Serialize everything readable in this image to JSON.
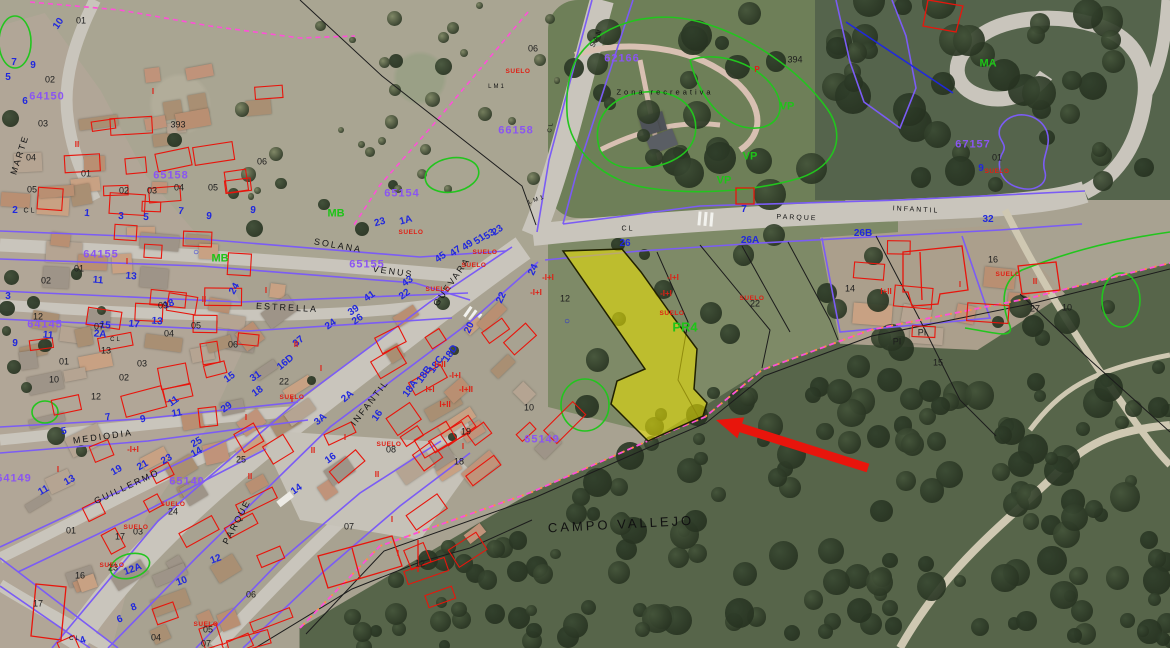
{
  "map": {
    "description": "Aerial cadastral map with highlighted parcel",
    "colors": {
      "highlight_fill": "#f0e800",
      "highlight_outline": "#202000",
      "arrow": "#e8150c",
      "street_line": "#7b5cf5",
      "portal_number": "#2028dd",
      "parcel_line_red": "#e8150c",
      "zone_green": "#1ec418",
      "boundary_magenta": "#ff50d8"
    },
    "highlight": {
      "parcel_polygon": [
        [
          563,
          251
        ],
        [
          622,
          249
        ],
        [
          641,
          272
        ],
        [
          668,
          310
        ],
        [
          697,
          349
        ],
        [
          694,
          389
        ],
        [
          707,
          403
        ],
        [
          703,
          416
        ],
        [
          648,
          441
        ],
        [
          611,
          404
        ],
        [
          617,
          381
        ],
        [
          645,
          369
        ]
      ],
      "arrow": {
        "tail": [
          868,
          468
        ],
        "head": [
          716,
          420
        ]
      }
    },
    "street_names": [
      {
        "t": "MARTE",
        "x": 20,
        "y": 155,
        "r": -72
      },
      {
        "t": "VENUS",
        "x": 393,
        "y": 272,
        "r": 8
      },
      {
        "t": "ESTRELLA",
        "x": 287,
        "y": 308,
        "r": 3
      },
      {
        "t": "SOLANA",
        "x": 338,
        "y": 246,
        "r": 10
      },
      {
        "t": "MEDIODIA",
        "x": 103,
        "y": 437,
        "r": -8
      },
      {
        "t": "GUILLERMO",
        "x": 127,
        "y": 487,
        "r": -25
      },
      {
        "t": "GUEVARA",
        "x": 452,
        "y": 282,
        "r": -55
      },
      {
        "t": "INFANTIL",
        "x": 370,
        "y": 403,
        "r": -52
      },
      {
        "t": "INFANTIL",
        "x": 916,
        "y": 210,
        "r": 3,
        "s": 7
      },
      {
        "t": "PARQUE",
        "x": 797,
        "y": 218,
        "r": 2,
        "s": 7
      },
      {
        "t": "PARQUE",
        "x": 237,
        "y": 522,
        "r": -62
      },
      {
        "t": "SAN",
        "x": 597,
        "y": 38,
        "r": -65,
        "s": 7
      },
      {
        "t": "CL",
        "x": 30,
        "y": 211,
        "r": 0,
        "s": 7
      },
      {
        "t": "CL",
        "x": 116,
        "y": 340,
        "r": 0,
        "s": 6
      },
      {
        "t": "CL",
        "x": 628,
        "y": 229,
        "r": 0,
        "s": 7
      },
      {
        "t": "CL",
        "x": 551,
        "y": 127,
        "r": -80,
        "s": 6
      },
      {
        "t": "CL",
        "x": 75,
        "y": 639,
        "r": 0,
        "s": 6
      },
      {
        "t": "LM1",
        "x": 497,
        "y": 87,
        "r": 0,
        "s": 6
      },
      {
        "t": "LM1",
        "x": 537,
        "y": 200,
        "r": -20,
        "s": 6
      }
    ],
    "area_labels": [
      {
        "t": "CAMPO VALLEJO",
        "x": 621,
        "y": 524,
        "r": -3,
        "s": 13
      },
      {
        "t": "Zona recreativa",
        "x": 665,
        "y": 92,
        "r": 0,
        "s": 7.5
      }
    ],
    "zone_labels": [
      {
        "t": "VP",
        "x": 787,
        "y": 107
      },
      {
        "t": "VP",
        "x": 750,
        "y": 157
      },
      {
        "t": "VP",
        "x": 724,
        "y": 181
      },
      {
        "t": "MA",
        "x": 988,
        "y": 64
      },
      {
        "t": "MB",
        "x": 336,
        "y": 214
      },
      {
        "t": "MB",
        "x": 220,
        "y": 259
      },
      {
        "t": "PR4",
        "x": 685,
        "y": 327,
        "r": 0,
        "s": 13
      }
    ],
    "block_codes": [
      {
        "t": "64150",
        "x": 47,
        "y": 97
      },
      {
        "t": "65158",
        "x": 171,
        "y": 176
      },
      {
        "t": "64155",
        "x": 101,
        "y": 255
      },
      {
        "t": "64145",
        "x": 45,
        "y": 325
      },
      {
        "t": "64149",
        "x": 14,
        "y": 479
      },
      {
        "t": "65140",
        "x": 187,
        "y": 482
      },
      {
        "t": "65155",
        "x": 367,
        "y": 265
      },
      {
        "t": "65154",
        "x": 402,
        "y": 194
      },
      {
        "t": "65149",
        "x": 542,
        "y": 440
      },
      {
        "t": "62166",
        "x": 622,
        "y": 59
      },
      {
        "t": "66158",
        "x": 516,
        "y": 131
      },
      {
        "t": "67157",
        "x": 973,
        "y": 145
      }
    ],
    "street_numbers": [
      {
        "t": "10",
        "x": 59,
        "y": 24,
        "r": -55
      },
      {
        "t": "9",
        "x": 33,
        "y": 66
      },
      {
        "t": "7",
        "x": 14,
        "y": 63
      },
      {
        "t": "6",
        "x": 25,
        "y": 102
      },
      {
        "t": "5",
        "x": 8,
        "y": 78
      },
      {
        "t": "2",
        "x": 15,
        "y": 211
      },
      {
        "t": "1",
        "x": 87,
        "y": 214,
        "r": 5
      },
      {
        "t": "3",
        "x": 121,
        "y": 217,
        "r": 5
      },
      {
        "t": "5",
        "x": 146,
        "y": 218,
        "r": 5
      },
      {
        "t": "7",
        "x": 181,
        "y": 212,
        "r": 5
      },
      {
        "t": "9",
        "x": 209,
        "y": 217,
        "r": 5
      },
      {
        "t": "9",
        "x": 253,
        "y": 211,
        "r": 5
      },
      {
        "t": "11",
        "x": 98,
        "y": 281,
        "r": 5
      },
      {
        "t": "13",
        "x": 131,
        "y": 277,
        "r": 5
      },
      {
        "t": "18",
        "x": 169,
        "y": 305,
        "r": -20
      },
      {
        "t": "15",
        "x": 105,
        "y": 326,
        "r": 5
      },
      {
        "t": "17",
        "x": 134,
        "y": 325,
        "r": 5
      },
      {
        "t": "13",
        "x": 157,
        "y": 322,
        "r": 5
      },
      {
        "t": "11",
        "x": 48,
        "y": 336,
        "r": 5
      },
      {
        "t": "9",
        "x": 15,
        "y": 344,
        "r": 5
      },
      {
        "t": "3",
        "x": 8,
        "y": 297
      },
      {
        "t": "2A",
        "x": 100,
        "y": 335,
        "r": 5
      },
      {
        "t": "23",
        "x": 380,
        "y": 223,
        "r": -15
      },
      {
        "t": "1A",
        "x": 406,
        "y": 221,
        "r": -15
      },
      {
        "t": "43",
        "x": 408,
        "y": 282,
        "r": -35
      },
      {
        "t": "41",
        "x": 370,
        "y": 297,
        "r": -35
      },
      {
        "t": "39",
        "x": 354,
        "y": 311,
        "r": -35
      },
      {
        "t": "26",
        "x": 358,
        "y": 320,
        "r": -35
      },
      {
        "t": "22",
        "x": 405,
        "y": 295,
        "r": -35
      },
      {
        "t": "24",
        "x": 331,
        "y": 325,
        "r": -35
      },
      {
        "t": "45",
        "x": 441,
        "y": 258,
        "r": -35
      },
      {
        "t": "47",
        "x": 456,
        "y": 252,
        "r": -35
      },
      {
        "t": "49",
        "x": 468,
        "y": 246,
        "r": -35
      },
      {
        "t": "51",
        "x": 480,
        "y": 240,
        "r": -35
      },
      {
        "t": "53",
        "x": 490,
        "y": 235,
        "r": -35
      },
      {
        "t": "23",
        "x": 498,
        "y": 231,
        "r": -35
      },
      {
        "t": "24",
        "x": 534,
        "y": 270,
        "r": -65
      },
      {
        "t": "22",
        "x": 502,
        "y": 298,
        "r": -65
      },
      {
        "t": "20",
        "x": 470,
        "y": 328,
        "r": -65
      },
      {
        "t": "18A",
        "x": 411,
        "y": 389,
        "r": -55
      },
      {
        "t": "18B",
        "x": 425,
        "y": 375,
        "r": -55
      },
      {
        "t": "18C",
        "x": 437,
        "y": 365,
        "r": -55
      },
      {
        "t": "18D",
        "x": 451,
        "y": 354,
        "r": -55
      },
      {
        "t": "16D",
        "x": 286,
        "y": 363,
        "r": -40
      },
      {
        "t": "37",
        "x": 299,
        "y": 342,
        "r": -40
      },
      {
        "t": "3A",
        "x": 321,
        "y": 420,
        "r": -40
      },
      {
        "t": "2A",
        "x": 348,
        "y": 397,
        "r": -40
      },
      {
        "t": "16",
        "x": 378,
        "y": 416,
        "r": -55
      },
      {
        "t": "16",
        "x": 331,
        "y": 459,
        "r": -35
      },
      {
        "t": "14",
        "x": 297,
        "y": 490,
        "r": -35
      },
      {
        "t": "15",
        "x": 230,
        "y": 378,
        "r": -35
      },
      {
        "t": "31",
        "x": 256,
        "y": 377,
        "r": -35
      },
      {
        "t": "18",
        "x": 258,
        "y": 392,
        "r": -35
      },
      {
        "t": "29",
        "x": 227,
        "y": 408,
        "r": -35
      },
      {
        "t": "11",
        "x": 174,
        "y": 402,
        "r": -35
      },
      {
        "t": "24",
        "x": 235,
        "y": 289,
        "r": -60
      },
      {
        "t": "26",
        "x": 625,
        "y": 244
      },
      {
        "t": "26A",
        "x": 750,
        "y": 241
      },
      {
        "t": "26B",
        "x": 863,
        "y": 234
      },
      {
        "t": "32",
        "x": 988,
        "y": 220
      },
      {
        "t": "7",
        "x": 744,
        "y": 210
      },
      {
        "t": "9",
        "x": 981,
        "y": 169
      },
      {
        "t": "12A",
        "x": 133,
        "y": 570,
        "r": -20
      },
      {
        "t": "10",
        "x": 182,
        "y": 582,
        "r": -20
      },
      {
        "t": "12",
        "x": 216,
        "y": 560,
        "r": -20
      },
      {
        "t": "8",
        "x": 134,
        "y": 608,
        "r": -20
      },
      {
        "t": "6",
        "x": 120,
        "y": 620,
        "r": -20
      },
      {
        "t": "4",
        "x": 83,
        "y": 641,
        "r": -20
      },
      {
        "t": "19",
        "x": 117,
        "y": 471,
        "r": -30
      },
      {
        "t": "21",
        "x": 143,
        "y": 466,
        "r": -30
      },
      {
        "t": "23",
        "x": 167,
        "y": 460,
        "r": -30
      },
      {
        "t": "25",
        "x": 197,
        "y": 443,
        "r": -30
      },
      {
        "t": "14",
        "x": 197,
        "y": 453,
        "r": -30
      },
      {
        "t": "13",
        "x": 70,
        "y": 481,
        "r": -30
      },
      {
        "t": "11",
        "x": 44,
        "y": 491,
        "r": -30
      },
      {
        "t": "7",
        "x": 108,
        "y": 418,
        "r": -10
      },
      {
        "t": "9",
        "x": 143,
        "y": 420,
        "r": -10
      },
      {
        "t": "11",
        "x": 177,
        "y": 414,
        "r": -10
      },
      {
        "t": "5",
        "x": 64,
        "y": 432,
        "r": -10
      }
    ],
    "parcel_numbers": [
      {
        "t": "394",
        "x": 795,
        "y": 60
      },
      {
        "t": "393",
        "x": 178,
        "y": 125
      },
      {
        "t": "01",
        "x": 81,
        "y": 21
      },
      {
        "t": "02",
        "x": 50,
        "y": 80
      },
      {
        "t": "03",
        "x": 43,
        "y": 124
      },
      {
        "t": "04",
        "x": 31,
        "y": 158
      },
      {
        "t": "05",
        "x": 32,
        "y": 190
      },
      {
        "t": "06",
        "x": 262,
        "y": 162
      },
      {
        "t": "01",
        "x": 86,
        "y": 174
      },
      {
        "t": "02",
        "x": 124,
        "y": 191
      },
      {
        "t": "03",
        "x": 152,
        "y": 191
      },
      {
        "t": "04",
        "x": 179,
        "y": 188
      },
      {
        "t": "05",
        "x": 213,
        "y": 188
      },
      {
        "t": "01",
        "x": 79,
        "y": 269
      },
      {
        "t": "02",
        "x": 46,
        "y": 281
      },
      {
        "t": "09",
        "x": 163,
        "y": 306
      },
      {
        "t": "07",
        "x": 99,
        "y": 327
      },
      {
        "t": "05",
        "x": 196,
        "y": 326
      },
      {
        "t": "04",
        "x": 169,
        "y": 334
      },
      {
        "t": "03",
        "x": 142,
        "y": 364
      },
      {
        "t": "02",
        "x": 124,
        "y": 378
      },
      {
        "t": "01",
        "x": 64,
        "y": 362
      },
      {
        "t": "13",
        "x": 106,
        "y": 351
      },
      {
        "t": "10",
        "x": 54,
        "y": 380
      },
      {
        "t": "12",
        "x": 38,
        "y": 317
      },
      {
        "t": "06",
        "x": 233,
        "y": 345
      },
      {
        "t": "22",
        "x": 284,
        "y": 382
      },
      {
        "t": "12",
        "x": 96,
        "y": 397
      },
      {
        "t": "16",
        "x": 80,
        "y": 576
      },
      {
        "t": "23",
        "x": 113,
        "y": 568
      },
      {
        "t": "17",
        "x": 38,
        "y": 604
      },
      {
        "t": "17",
        "x": 120,
        "y": 537
      },
      {
        "t": "24",
        "x": 173,
        "y": 512
      },
      {
        "t": "03",
        "x": 138,
        "y": 532
      },
      {
        "t": "01",
        "x": 71,
        "y": 531
      },
      {
        "t": "06",
        "x": 251,
        "y": 595
      },
      {
        "t": "05",
        "x": 208,
        "y": 630
      },
      {
        "t": "04",
        "x": 156,
        "y": 638
      },
      {
        "t": "07",
        "x": 206,
        "y": 644
      },
      {
        "t": "07",
        "x": 349,
        "y": 527
      },
      {
        "t": "08",
        "x": 391,
        "y": 450
      },
      {
        "t": "25",
        "x": 241,
        "y": 460
      },
      {
        "t": "19",
        "x": 466,
        "y": 432
      },
      {
        "t": "18",
        "x": 459,
        "y": 462
      },
      {
        "t": "12",
        "x": 420,
        "y": 564
      },
      {
        "t": "12",
        "x": 565,
        "y": 299
      },
      {
        "t": "22",
        "x": 755,
        "y": 304
      },
      {
        "t": "14",
        "x": 850,
        "y": 289
      },
      {
        "t": "16",
        "x": 993,
        "y": 260
      },
      {
        "t": "15",
        "x": 938,
        "y": 363
      },
      {
        "t": "10",
        "x": 1067,
        "y": 308
      },
      {
        "t": "27",
        "x": 1035,
        "y": 309
      },
      {
        "t": "01",
        "x": 997,
        "y": 158
      },
      {
        "t": "06",
        "x": 533,
        "y": 49
      },
      {
        "t": "PI",
        "x": 897,
        "y": 342
      },
      {
        "t": "PI",
        "x": 922,
        "y": 333
      },
      {
        "t": "10",
        "x": 529,
        "y": 408
      }
    ],
    "suelo_label_text": "SUELO",
    "suelo_labels": [
      {
        "x": 518,
        "y": 72
      },
      {
        "x": 672,
        "y": 314
      },
      {
        "x": 752,
        "y": 299
      },
      {
        "x": 997,
        "y": 172
      },
      {
        "x": 1008,
        "y": 275
      },
      {
        "x": 438,
        "y": 290
      },
      {
        "x": 485,
        "y": 253
      },
      {
        "x": 474,
        "y": 266
      },
      {
        "x": 411,
        "y": 233
      },
      {
        "x": 173,
        "y": 505
      },
      {
        "x": 136,
        "y": 528
      },
      {
        "x": 112,
        "y": 566
      },
      {
        "x": 206,
        "y": 625
      },
      {
        "x": 292,
        "y": 398
      },
      {
        "x": 389,
        "y": 445
      }
    ],
    "height_marks": [
      {
        "t": "I",
        "x": 266,
        "y": 291
      },
      {
        "t": "II",
        "x": 296,
        "y": 345
      },
      {
        "t": "I",
        "x": 321,
        "y": 369
      },
      {
        "t": "I",
        "x": 246,
        "y": 418
      },
      {
        "t": "I",
        "x": 292,
        "y": 400
      },
      {
        "t": "I",
        "x": 345,
        "y": 438
      },
      {
        "t": "I",
        "x": 463,
        "y": 447
      },
      {
        "t": "I",
        "x": 398,
        "y": 554
      },
      {
        "t": "II",
        "x": 313,
        "y": 451
      },
      {
        "t": "-I+I",
        "x": 548,
        "y": 278
      },
      {
        "t": "-I+I",
        "x": 536,
        "y": 293
      },
      {
        "t": "I+II",
        "x": 440,
        "y": 365
      },
      {
        "t": "-I+I",
        "x": 455,
        "y": 376
      },
      {
        "t": "I+I",
        "x": 430,
        "y": 390
      },
      {
        "t": "-I+II",
        "x": 466,
        "y": 390
      },
      {
        "t": "I+II",
        "x": 445,
        "y": 405
      },
      {
        "t": "I+II",
        "x": 886,
        "y": 292
      },
      {
        "t": "II",
        "x": 1035,
        "y": 282
      },
      {
        "t": "I",
        "x": 960,
        "y": 285
      },
      {
        "t": "P",
        "x": 757,
        "y": 70
      },
      {
        "t": "-I+I",
        "x": 673,
        "y": 278
      },
      {
        "t": "-I+I",
        "x": 666,
        "y": 294
      },
      {
        "t": "I",
        "x": 153,
        "y": 92
      },
      {
        "t": "II",
        "x": 77,
        "y": 145
      },
      {
        "t": "I",
        "x": 127,
        "y": 262
      },
      {
        "t": "II",
        "x": 204,
        "y": 300
      },
      {
        "t": "I",
        "x": 58,
        "y": 470
      },
      {
        "t": "II",
        "x": 250,
        "y": 477
      },
      {
        "t": "-I+I",
        "x": 133,
        "y": 450
      },
      {
        "t": "I",
        "x": 392,
        "y": 520
      },
      {
        "t": "II",
        "x": 377,
        "y": 475
      }
    ],
    "symbols": [
      {
        "t": "○",
        "x": 567,
        "y": 322
      },
      {
        "t": "○",
        "x": 196,
        "y": 253
      }
    ]
  }
}
